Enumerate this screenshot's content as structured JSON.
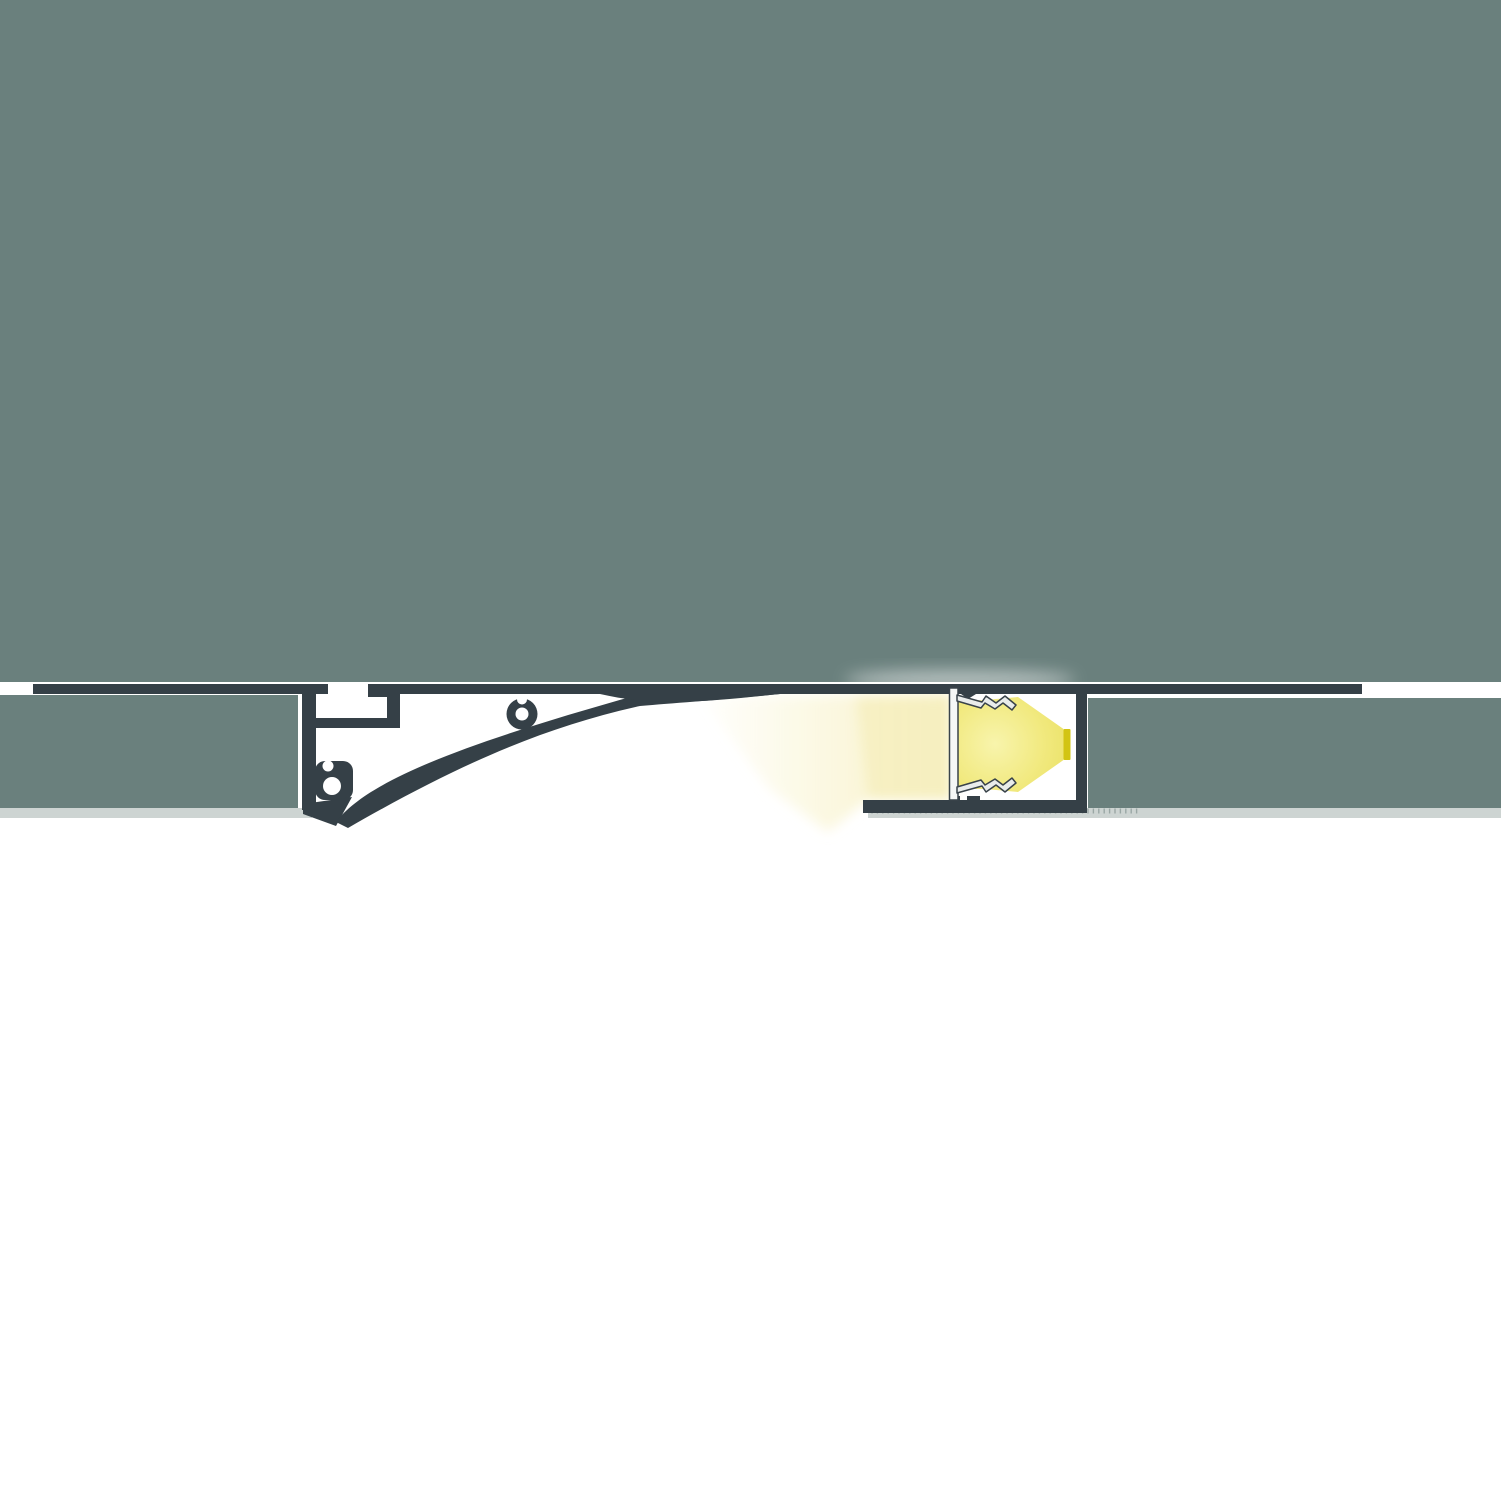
{
  "diagram": {
    "kind": "cross-section",
    "subject": "recessed-led-cove-profile-in-plasterboard-ceiling",
    "has_text": false
  },
  "colors": {
    "page_bg": "#ffffff",
    "plaster_gray": "#6a807d",
    "profile_dark": "#354047",
    "board_edge_light": "#cdd4d2",
    "board_tick": "#9aa7a5",
    "aluminium_fill": "#e9eceb",
    "aluminium_plate": "#f5f7f6",
    "aluminium_stroke": "#39434a",
    "cone_core": "#f8f4ac",
    "cone_main": "#f1e97e",
    "cone_edge": "#e9df60",
    "led_strip_yellow": "#d2c413",
    "glow_soft": "#fbf7dd",
    "glow_warm": "#f6efbe",
    "spill_white": "#ffffff"
  },
  "board_ticks": {
    "x_start": 872,
    "x_end": 1142,
    "step": 5.4,
    "y1": 808.5,
    "y2": 813.5,
    "width": 1.4
  },
  "components": {
    "ceiling_panel": "upper plaster / ceiling mass",
    "drywall_left": "left plasterboard panel",
    "drywall_right": "right plasterboard panel",
    "shadow_gap_line": "dark ceiling shadow-gap line",
    "cove_profile": "curved aluminium cove reflector profile",
    "mounting_clips": "screw-port clips on profile",
    "led_channel": "aluminium LED channel with spring arms",
    "led_strip": "LED strip light source",
    "light_cone": "direct light beam",
    "light_glow": "soft wall-wash glow"
  }
}
